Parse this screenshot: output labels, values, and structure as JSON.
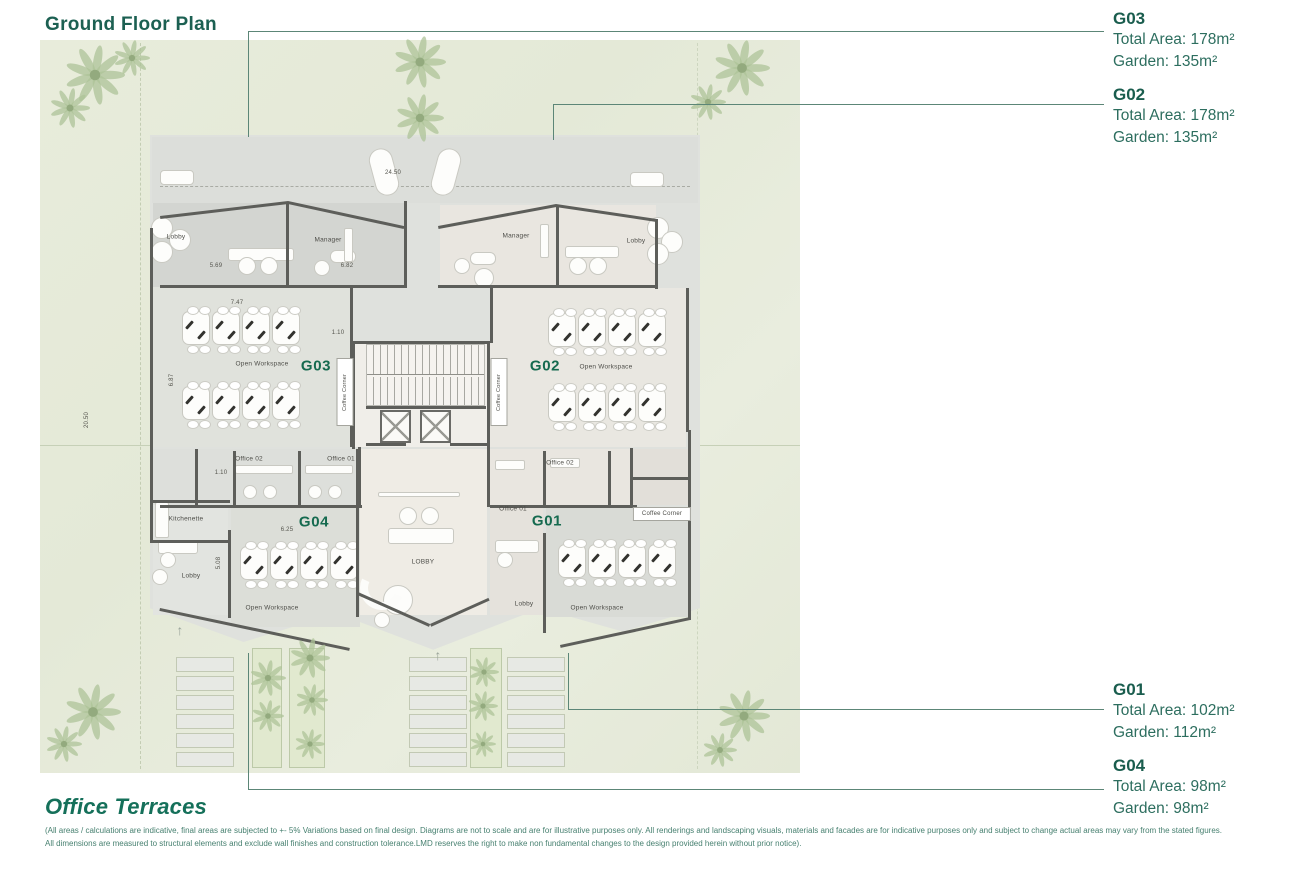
{
  "page": {
    "title": "Ground Floor Plan",
    "brand": "Office Terraces",
    "disclaimer_line1": "(All areas / calculations are indicative, final areas are subjected to +- 5% Variations based on final design. Diagrams are not to scale and are for illustrative purposes only. All renderings and landscaping visuals, materials and facades are for indicative purposes only and subject to change actual areas may vary from the stated figures.",
    "disclaimer_line2": "All dimensions are measured to structural elements and exclude wall finishes and construction tolerance.LMD reserves the right to make non fundamental changes to the design provided herein without prior notice)."
  },
  "colors": {
    "accent_teal": "#1C6052",
    "unit_label_green": "#156A4F",
    "leader_line": "#5C8677",
    "garden_green": "#E6EBDA",
    "slab_gray": "#DFE1DD",
    "wall_gray": "#5D5E5A"
  },
  "callouts": [
    {
      "id": "G03",
      "total": "Total Area: 178m²",
      "garden": "Garden: 135m²"
    },
    {
      "id": "G02",
      "total": "Total Area: 178m²",
      "garden": "Garden: 135m²"
    },
    {
      "id": "G01",
      "total": "Total Area: 102m²",
      "garden": "Garden: 112m²"
    },
    {
      "id": "G04",
      "total": "Total Area: 98m²",
      "garden": "Garden: 98m²"
    }
  ],
  "plan": {
    "unit_labels": [
      {
        "text": "G03",
        "x": 316,
        "y": 366
      },
      {
        "text": "G02",
        "x": 545,
        "y": 366
      },
      {
        "text": "G04",
        "x": 314,
        "y": 522
      },
      {
        "text": "G01",
        "x": 547,
        "y": 521
      }
    ],
    "room_labels": [
      {
        "text": "Lobby",
        "x": 176,
        "y": 237
      },
      {
        "text": "Manager",
        "x": 328,
        "y": 240
      },
      {
        "text": "Open Workspace",
        "x": 262,
        "y": 364
      },
      {
        "text": "Coffee Corner",
        "x": 345,
        "y": 392,
        "cls": "cc-v"
      },
      {
        "text": "Manager",
        "x": 516,
        "y": 236
      },
      {
        "text": "Lobby",
        "x": 636,
        "y": 241
      },
      {
        "text": "Open Workspace",
        "x": 606,
        "y": 367
      },
      {
        "text": "Coffee Corner",
        "x": 499,
        "y": 392,
        "cls": "cc-v"
      },
      {
        "text": "Office 02",
        "x": 249,
        "y": 459
      },
      {
        "text": "Office 01",
        "x": 341,
        "y": 459
      },
      {
        "text": "Kitchenette",
        "x": 186,
        "y": 519
      },
      {
        "text": "Lobby",
        "x": 191,
        "y": 576
      },
      {
        "text": "Open Workspace",
        "x": 272,
        "y": 608
      },
      {
        "text": "LOBBY",
        "x": 423,
        "y": 562
      },
      {
        "text": "Office 02",
        "x": 560,
        "y": 463
      },
      {
        "text": "Office 01",
        "x": 513,
        "y": 509
      },
      {
        "text": "Coffee Corner",
        "x": 662,
        "y": 514,
        "cls": "cc-h"
      },
      {
        "text": "Lobby",
        "x": 524,
        "y": 604
      },
      {
        "text": "Open Workspace",
        "x": 597,
        "y": 608
      }
    ],
    "dim_labels": [
      {
        "text": "24.50",
        "x": 393,
        "y": 173
      },
      {
        "text": "5.69",
        "x": 216,
        "y": 266
      },
      {
        "text": "6.82",
        "x": 347,
        "y": 266
      },
      {
        "text": "7.47",
        "x": 237,
        "y": 303
      },
      {
        "text": "1.10",
        "x": 338,
        "y": 333
      },
      {
        "text": "6.87",
        "x": 172,
        "y": 380,
        "vert": true
      },
      {
        "text": "20.50",
        "x": 87,
        "y": 420,
        "vert": true
      },
      {
        "text": "1.10",
        "x": 221,
        "y": 473
      },
      {
        "text": "6.25",
        "x": 287,
        "y": 530
      },
      {
        "text": "5.08",
        "x": 219,
        "y": 563,
        "vert": true
      }
    ]
  }
}
